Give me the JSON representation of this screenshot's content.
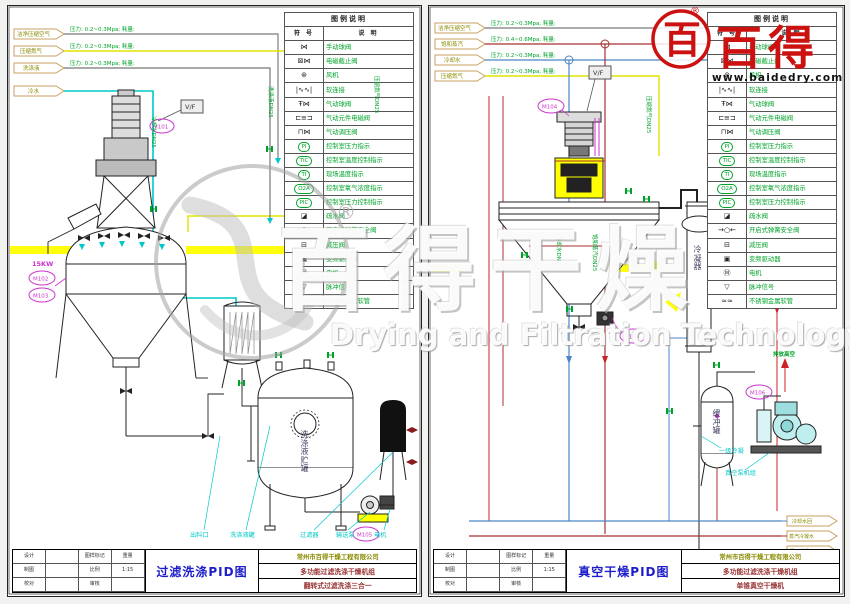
{
  "legend": {
    "title": "图例说明",
    "col_symbol": "符 号",
    "col_desc": "说 明",
    "rows": [
      {
        "sym": "⋈",
        "desc": "手动球阀"
      },
      {
        "sym": "⊠⋈",
        "desc": "电磁截止阀"
      },
      {
        "sym": "⊛",
        "desc": "风机"
      },
      {
        "sym": "|∿∿|",
        "desc": "软连接"
      },
      {
        "sym": "Ŧ⋈",
        "desc": "气动球阀"
      },
      {
        "sym": "⊏≡⊐",
        "desc": "气动元件电磁阀"
      },
      {
        "sym": "⊓⋈",
        "desc": "气动调压阀"
      },
      {
        "sym": "PI",
        "desc": "控制室压力指示"
      },
      {
        "sym": "TIC",
        "desc": "控制室温度控制指示"
      },
      {
        "sym": "TI",
        "desc": "现场温度指示"
      },
      {
        "sym": "O2A",
        "desc": "控制室氧气浓度指示"
      },
      {
        "sym": "PIC",
        "desc": "控制室压力控制指示"
      },
      {
        "sym": "◪",
        "desc": "疏水阀"
      },
      {
        "sym": "→○←",
        "desc": "开启式弹簧安全阀"
      },
      {
        "sym": "⊟",
        "desc": "减压阀"
      },
      {
        "sym": "▣",
        "desc": "变频驱动器"
      },
      {
        "sym": "Ⓜ",
        "desc": "电机"
      },
      {
        "sym": "▽",
        "desc": "脉冲信号"
      },
      {
        "sym": "≈≈",
        "desc": "不锈钢金属软管"
      }
    ]
  },
  "watermark": {
    "brand": "百得干燥",
    "registered": "®",
    "subtitle": "Drying and Filtration Technology"
  },
  "logo": {
    "seal": "百",
    "name": "百得",
    "reg": "®",
    "url": "www.baidedry.com"
  },
  "left": {
    "title": "过滤洗涤PID图",
    "utilities": [
      {
        "name": "洁净压缩空气",
        "spec": "压力: 0.2~0.3Mpa; 耗量:"
      },
      {
        "name": "压缩氮气",
        "spec": "压力: 0.2~0.3Mpa; 耗量:"
      },
      {
        "name": "洗涤液",
        "spec": "压力: 0.2~0.3Mpa; 耗量:"
      },
      {
        "name": "冷水",
        "spec": ""
      }
    ],
    "pipe_labels": [
      "冷却水DN25",
      "洗涤液DN25",
      "压缩氮气DN25"
    ],
    "tags": {
      "m101": "M101",
      "m102": "M102",
      "m103": "M103",
      "m105": "M105",
      "vf": "V/F",
      "power": "15KW"
    },
    "vessel_text": "洗涤液贮罐",
    "equip_labels": [
      "出料口",
      "洗涤液罐",
      "过滤器",
      "输送泵",
      "电机"
    ],
    "tb": {
      "company": "常州市百得干燥工程有限公司",
      "product": "多功能过滤洗涤干燥机组",
      "model": "翻转式过滤洗涤三合一",
      "fields": [
        "设计",
        "制图",
        "校对",
        "审核"
      ],
      "cols": [
        "图样标记",
        "重量",
        "比例"
      ],
      "scale": "1:15"
    }
  },
  "right": {
    "title": "真空干燥PID图",
    "utilities": [
      {
        "name": "洁净压缩空气",
        "spec": "压力: 0.2~0.3Mpa; 耗量:"
      },
      {
        "name": "饱和蒸汽",
        "spec": "压力: 0.4~0.6Mpa; 耗量:"
      },
      {
        "name": "冷却水",
        "spec": "压力: 0.2~0.3Mpa; 耗量:"
      },
      {
        "name": "压缩氮气",
        "spec": "压力: 0.2~0.3Mpa; 耗量:"
      }
    ],
    "pipe_labels": [
      "冷却水DN25",
      "饱和蒸汽DN25",
      "压缩氮气DN25"
    ],
    "tags": {
      "m104": "M104",
      "m105": "M105",
      "m106": "M106",
      "vf": "V/F"
    },
    "condenser_text": "冷凝器",
    "buffer_text": "缓冲罐",
    "vent_label": "排放高空",
    "cond_label": "一级冷凝",
    "pump_label": "真空泵机组",
    "outlets": [
      "蒸汽冷凝水",
      "冷却水回",
      "循环冷却水"
    ],
    "tb": {
      "company": "常州市百得干燥工程有限公司",
      "product": "多功能过滤洗涤干燥机组",
      "model": "单锥真空干燥机",
      "fields": [
        "设计",
        "制图",
        "校对",
        "审核"
      ],
      "cols": [
        "图样标记",
        "重量",
        "比例"
      ],
      "scale": "1:15"
    }
  }
}
